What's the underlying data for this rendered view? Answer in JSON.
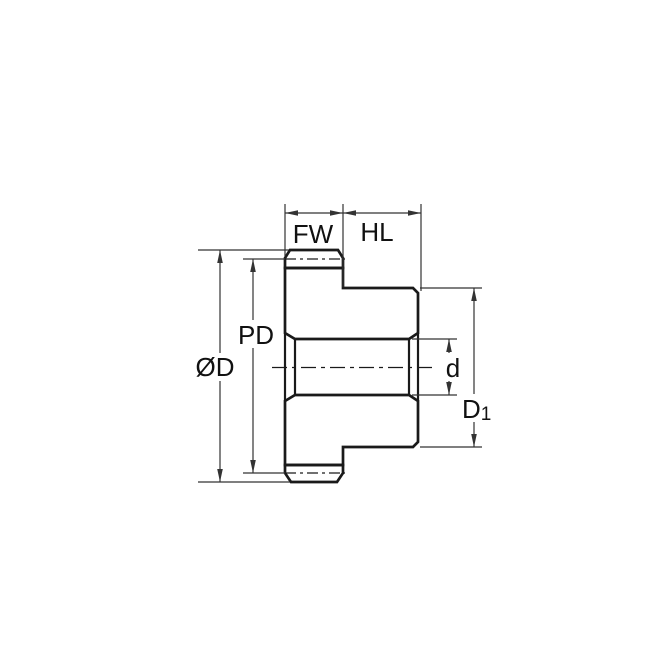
{
  "drawing": {
    "labels": {
      "face_width": "FW",
      "hub_length": "HL",
      "outside_diameter": "ØD",
      "pitch_diameter": "PD",
      "bore_diameter": "d",
      "hub_diameter_main": "D",
      "hub_diameter_sub": "1"
    },
    "colors": {
      "part_fill": "#c5e6f8",
      "part_face_fill": "#ffffff",
      "outline": "#1a1a1a",
      "dimension_lines": "#333333",
      "text": "#111111",
      "background": "#ffffff"
    }
  }
}
